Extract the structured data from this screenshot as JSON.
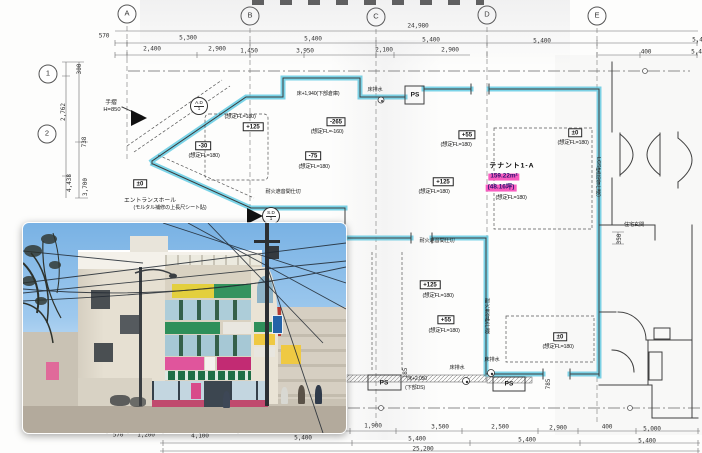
{
  "document": {
    "type_note": "1F floor plan scan with exterior building photo"
  },
  "colors": {
    "wall_highlight": "#56c8e2",
    "tenant_highlight": "#f85cc0",
    "paper": "#fdfdfc"
  },
  "tenant": {
    "name": "テナント1-A",
    "area_m2": "159.22m²",
    "area_tsubo": "(48.16坪)",
    "fl": "(想定FL=180)"
  },
  "labels": [
    {
      "t": "A",
      "x": 127,
      "y": 14,
      "s": "g",
      "n": "grid-bubble-a"
    },
    {
      "t": "B",
      "x": 250,
      "y": 16,
      "s": "g",
      "n": "grid-bubble-b"
    },
    {
      "t": "C",
      "x": 376,
      "y": 17,
      "s": "g",
      "n": "grid-bubble-c"
    },
    {
      "t": "D",
      "x": 487,
      "y": 15,
      "s": "g",
      "n": "grid-bubble-d"
    },
    {
      "t": "E",
      "x": 597,
      "y": 16,
      "s": "g",
      "n": "grid-bubble-e"
    },
    {
      "t": "1",
      "x": 48,
      "y": 74,
      "s": "g",
      "n": "grid-bubble-1"
    },
    {
      "t": "2",
      "x": 47,
      "y": 134,
      "s": "g",
      "n": "grid-bubble-2"
    },
    {
      "t": "24,980",
      "x": 418,
      "y": 27,
      "s": "d"
    },
    {
      "t": "570",
      "x": 104,
      "y": 37,
      "s": "d"
    },
    {
      "t": "5,300",
      "x": 188,
      "y": 39,
      "s": "d"
    },
    {
      "t": "5,400",
      "x": 313,
      "y": 40,
      "s": "d"
    },
    {
      "t": "5,400",
      "x": 431,
      "y": 41,
      "s": "d"
    },
    {
      "t": "5,400",
      "x": 542,
      "y": 42,
      "s": "d"
    },
    {
      "t": "5,400",
      "x": 701,
      "y": 41,
      "s": "d"
    },
    {
      "t": "2,400",
      "x": 152,
      "y": 50,
      "s": "d"
    },
    {
      "t": "2,900",
      "x": 217,
      "y": 50,
      "s": "d"
    },
    {
      "t": "1,450",
      "x": 249,
      "y": 52,
      "s": "d"
    },
    {
      "t": "3,950",
      "x": 305,
      "y": 52,
      "s": "d"
    },
    {
      "t": "2,100",
      "x": 384,
      "y": 51,
      "s": "d"
    },
    {
      "t": "2,900",
      "x": 450,
      "y": 51,
      "s": "d"
    },
    {
      "t": "400",
      "x": 646,
      "y": 53,
      "s": "d"
    },
    {
      "t": "5,400",
      "x": 700,
      "y": 53,
      "s": "d"
    },
    {
      "t": "300",
      "x": 80,
      "y": 69,
      "s": "dv"
    },
    {
      "t": "2,762",
      "x": 64,
      "y": 112,
      "s": "dv"
    },
    {
      "t": "738",
      "x": 85,
      "y": 142,
      "s": "dv"
    },
    {
      "t": "4,438",
      "x": 70,
      "y": 183,
      "s": "dv"
    },
    {
      "t": "3,700",
      "x": 86,
      "y": 187,
      "s": "dv"
    },
    {
      "t": "570",
      "x": 118,
      "y": 436,
      "s": "d"
    },
    {
      "t": "1,200",
      "x": 146,
      "y": 436,
      "s": "d"
    },
    {
      "t": "4,100",
      "x": 200,
      "y": 437,
      "s": "d"
    },
    {
      "t": "5,400",
      "x": 303,
      "y": 439,
      "s": "d"
    },
    {
      "t": "1,900",
      "x": 373,
      "y": 427,
      "s": "d"
    },
    {
      "t": "3,500",
      "x": 440,
      "y": 428,
      "s": "d"
    },
    {
      "t": "2,500",
      "x": 500,
      "y": 428,
      "s": "d"
    },
    {
      "t": "2,900",
      "x": 558,
      "y": 429,
      "s": "d"
    },
    {
      "t": "400",
      "x": 607,
      "y": 428,
      "s": "d"
    },
    {
      "t": "5,000",
      "x": 652,
      "y": 430,
      "s": "d"
    },
    {
      "t": "5,400",
      "x": 417,
      "y": 440,
      "s": "d"
    },
    {
      "t": "5,400",
      "x": 527,
      "y": 441,
      "s": "d"
    },
    {
      "t": "5,400",
      "x": 647,
      "y": 442,
      "s": "d"
    },
    {
      "t": "25,200",
      "x": 423,
      "y": 450,
      "s": "d"
    },
    {
      "t": "785",
      "x": 549,
      "y": 384,
      "s": "dv"
    },
    {
      "t": "185",
      "x": 406,
      "y": 373,
      "s": "dv"
    },
    {
      "t": "350",
      "x": 620,
      "y": 239,
      "s": "dv"
    },
    {
      "t": "+125",
      "x": 253,
      "y": 127,
      "s": "b",
      "n": "level-box"
    },
    {
      "t": "(想定FL=180)",
      "x": 240,
      "y": 117,
      "s": "f"
    },
    {
      "t": "-30",
      "x": 203,
      "y": 146,
      "s": "b",
      "n": "level-box"
    },
    {
      "t": "(想定FL=180)",
      "x": 204,
      "y": 156,
      "s": "f"
    },
    {
      "t": "-265",
      "x": 336,
      "y": 122,
      "s": "b",
      "n": "level-box"
    },
    {
      "t": "(想定FL=-160)",
      "x": 327,
      "y": 132,
      "s": "f"
    },
    {
      "t": "-75",
      "x": 313,
      "y": 156,
      "s": "b",
      "n": "level-box"
    },
    {
      "t": "(想定FL=180)",
      "x": 314,
      "y": 167,
      "s": "f"
    },
    {
      "t": "+55",
      "x": 467,
      "y": 135,
      "s": "b",
      "n": "level-box"
    },
    {
      "t": "(想定FL=180)",
      "x": 456,
      "y": 145,
      "s": "f"
    },
    {
      "t": "±0",
      "x": 575,
      "y": 133,
      "s": "b",
      "n": "level-box"
    },
    {
      "t": "(想定FL=180)",
      "x": 573,
      "y": 143,
      "s": "f"
    },
    {
      "t": "+125",
      "x": 443,
      "y": 182,
      "s": "b",
      "n": "level-box"
    },
    {
      "t": "(想定FL=180)",
      "x": 434,
      "y": 192,
      "s": "f"
    },
    {
      "t": "±0",
      "x": 140,
      "y": 184,
      "s": "b",
      "n": "level-box"
    },
    {
      "t": "+125",
      "x": 430,
      "y": 285,
      "s": "b",
      "n": "level-box"
    },
    {
      "t": "(想定FL=180)",
      "x": 438,
      "y": 296,
      "s": "f"
    },
    {
      "t": "+55",
      "x": 446,
      "y": 320,
      "s": "b",
      "n": "level-box"
    },
    {
      "t": "(想定FL=180)",
      "x": 444,
      "y": 331,
      "s": "f"
    },
    {
      "t": "±0",
      "x": 560,
      "y": 337,
      "s": "b",
      "n": "level-box"
    },
    {
      "t": "(想定FL=180)",
      "x": 558,
      "y": 347,
      "s": "f"
    },
    {
      "t": "テナント1-A",
      "x": 512,
      "y": 166,
      "s": "name",
      "n": "tenant-name"
    },
    {
      "t": "159.22m²",
      "x": 504,
      "y": 177,
      "s": "pink",
      "n": "tenant-area-m2"
    },
    {
      "t": "(48.16坪)",
      "x": 501,
      "y": 188,
      "s": "pink",
      "n": "tenant-area-tsubo"
    },
    {
      "t": "(想定FL=180)",
      "x": 511,
      "y": 198,
      "s": "f"
    },
    {
      "t": "手摺",
      "x": 111,
      "y": 103,
      "s": "n"
    },
    {
      "t": "H=850",
      "x": 112,
      "y": 110,
      "s": "n"
    },
    {
      "t": "エントランスホール",
      "x": 150,
      "y": 201,
      "s": "n",
      "n": "entrance-hall-note"
    },
    {
      "t": "(モルタル補修の上長尺シート貼)",
      "x": 170,
      "y": 209,
      "s": "n5"
    },
    {
      "t": "床+1,940(下部倉庫)",
      "x": 318,
      "y": 95,
      "s": "n5"
    },
    {
      "t": "床排水",
      "x": 375,
      "y": 91,
      "s": "n5"
    },
    {
      "t": "耐火遮音間仕切",
      "x": 283,
      "y": 193,
      "s": "n5"
    },
    {
      "t": "耐火遮音間仕切",
      "x": 437,
      "y": 242,
      "s": "n5"
    },
    {
      "t": "耐火遮音壁仕様",
      "x": 486,
      "y": 316,
      "s": "nv"
    },
    {
      "t": "LGS壁(防音仕様)",
      "x": 597,
      "y": 177,
      "s": "nv"
    },
    {
      "t": "住宅玄関",
      "x": 634,
      "y": 226,
      "s": "n5",
      "n": "residence-entrance-note"
    },
    {
      "t": "床排水",
      "x": 457,
      "y": 369,
      "s": "n5"
    },
    {
      "t": "床排水",
      "x": 492,
      "y": 361,
      "s": "n5"
    },
    {
      "t": "床+2,050",
      "x": 417,
      "y": 380,
      "s": "n5"
    },
    {
      "t": "(下部DS)",
      "x": 415,
      "y": 389,
      "s": "n5"
    },
    {
      "t": "PS",
      "x": 415,
      "y": 95,
      "s": "ps",
      "n": "pipe-shaft-label"
    },
    {
      "t": "PS",
      "x": 384,
      "y": 383,
      "s": "ps",
      "n": "pipe-shaft-label"
    },
    {
      "t": "PS",
      "x": 509,
      "y": 384,
      "s": "ps",
      "n": "pipe-shaft-label"
    },
    {
      "t": "A.D|1",
      "x": 199,
      "y": 106,
      "s": "bub",
      "n": "area-drain-bubble"
    },
    {
      "t": "S.D|1",
      "x": 271,
      "y": 216,
      "s": "bub",
      "n": "steel-door-bubble"
    }
  ]
}
